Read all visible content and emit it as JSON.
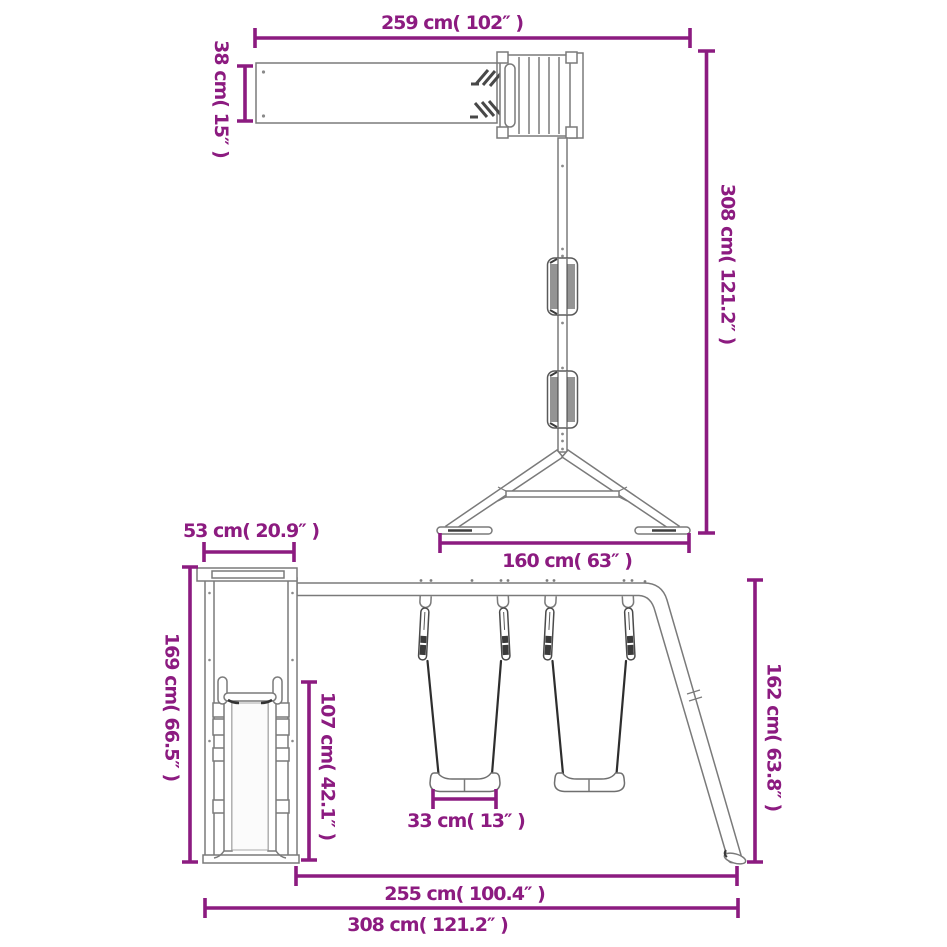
{
  "diagram": {
    "accent_color": "#8C1B80",
    "structure_color": "#7A7A7A",
    "dimensions": {
      "monkeybar_length": "259 cm( 102″ )",
      "monkeybar_beam_height": "38 cm( 15″ )",
      "monkeybar_total_height": "308 cm( 121.2″ )",
      "monkeybar_base_width": "160 cm( 63″ )",
      "slide_tower_depth": "53 cm( 20.9″ )",
      "slide_tower_height": "169 cm( 66.5″ )",
      "swing_seat_clearance": "107 cm( 42.1″ )",
      "swing_seat_width": "33 cm( 13″ )",
      "swing_frame_height": "162 cm( 63.8″ )",
      "swing_section_length": "255 cm( 100.4″ )",
      "swingset_total_length": "308 cm( 121.2″ )"
    }
  }
}
